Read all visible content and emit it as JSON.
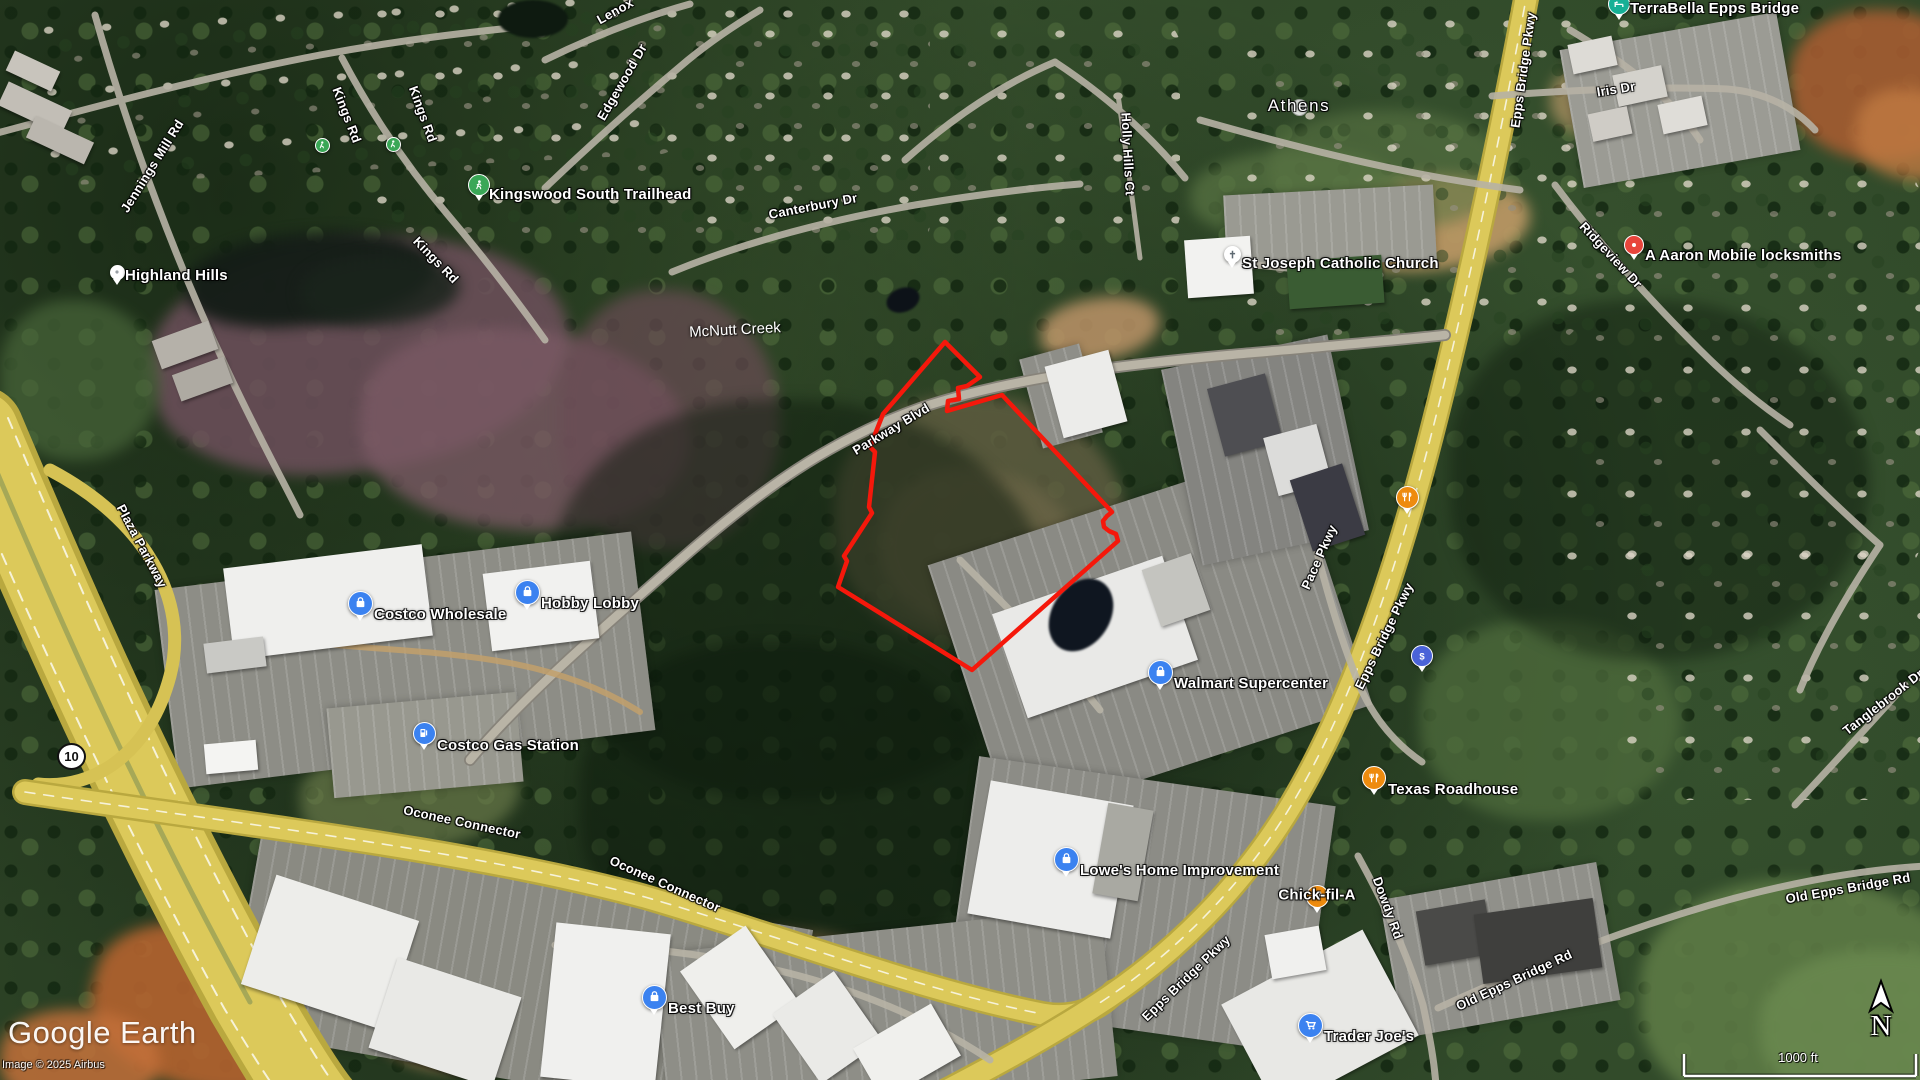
{
  "ui": {
    "logo": "Google Earth",
    "attribution": "Image © 2025 Airbus",
    "scale_label": "1000 ft",
    "north_label": "N",
    "route_shield": "10"
  },
  "map": {
    "pin_colors": {
      "shop": "#3b82f0",
      "cart": "#3b82f0",
      "gas": "#3b82f0",
      "food": "#ee8b0e",
      "dollar": "#4a63d8",
      "dot-red": "#e8453c",
      "lodging": "#16b096",
      "trail": "#3aa757",
      "trail-small": "#3aa757",
      "dot-white": "#ffffff",
      "church": "#ffffff",
      "city": "rgba(255,255,255,0.85)"
    },
    "places": [
      {
        "id": "highland-hills",
        "label": "Highland Hills",
        "pin": "dot-white",
        "x": 117,
        "y": 272,
        "size": 15,
        "dx": 8,
        "dy": -5
      },
      {
        "id": "trail-dot-west",
        "label": "",
        "pin": "trail-small",
        "x": 322,
        "y": 145,
        "size": 15
      },
      {
        "id": "trail-dot-east",
        "label": "",
        "pin": "trail-small",
        "x": 393,
        "y": 144,
        "size": 15
      },
      {
        "id": "kingswood-south-trailhead",
        "label": "Kingswood South Trailhead",
        "pin": "trail",
        "x": 479,
        "y": 185,
        "size": 22,
        "dx": 10,
        "dy": 1
      },
      {
        "id": "athens",
        "label": "Athens",
        "pin": "city",
        "x": 1299,
        "y": 107,
        "size": 17,
        "mode": "over",
        "cls": "city"
      },
      {
        "id": "st-joseph-catholic-church",
        "label": "St Joseph Catholic Church",
        "pin": "church",
        "x": 1232,
        "y": 254,
        "size": 17,
        "dx": 10,
        "dy": 1
      },
      {
        "id": "a-aaron-mobile-locksmiths",
        "label": "A Aaron Mobile locksmiths",
        "pin": "dot-red",
        "x": 1634,
        "y": 245,
        "size": 20,
        "dx": 11,
        "dy": 2
      },
      {
        "id": "terrabella-epps-bridge",
        "label": "TerraBella Epps Bridge",
        "pin": "lodging",
        "x": 1619,
        "y": 4,
        "size": 22,
        "dx": 11,
        "dy": -4
      },
      {
        "id": "costco-wholesale",
        "label": "Costco Wholesale",
        "pin": "shop",
        "x": 360,
        "y": 603,
        "size": 25,
        "dx": 14,
        "dy": 3
      },
      {
        "id": "hobby-lobby",
        "label": "Hobby Lobby",
        "pin": "shop",
        "x": 527,
        "y": 592,
        "size": 25,
        "dx": 14,
        "dy": 3
      },
      {
        "id": "costco-gas-station",
        "label": "Costco Gas Station",
        "pin": "gas",
        "x": 424,
        "y": 733,
        "size": 23,
        "dx": 13,
        "dy": 4
      },
      {
        "id": "walmart-supercenter",
        "label": "Walmart Supercenter",
        "pin": "shop",
        "x": 1160,
        "y": 672,
        "size": 25,
        "dx": 14,
        "dy": 3
      },
      {
        "id": "restaurant",
        "label": "",
        "pin": "food",
        "x": 1407,
        "y": 497,
        "size": 23
      },
      {
        "id": "bank",
        "label": "",
        "pin": "dollar",
        "x": 1422,
        "y": 656,
        "size": 22
      },
      {
        "id": "texas-roadhouse",
        "label": "Texas Roadhouse",
        "pin": "food",
        "x": 1374,
        "y": 778,
        "size": 24,
        "dx": 14,
        "dy": 3
      },
      {
        "id": "lowes-home-improvement",
        "label": "Lowe's Home Improvement",
        "pin": "shop",
        "x": 1066,
        "y": 859,
        "size": 25,
        "dx": 14,
        "dy": 3
      },
      {
        "id": "chick-fil-a",
        "label": "Chick-fil-A",
        "pin": "food",
        "x": 1317,
        "y": 896,
        "size": 23,
        "mode": "over"
      },
      {
        "id": "best-buy",
        "label": "Best Buy",
        "pin": "shop",
        "x": 654,
        "y": 997,
        "size": 25,
        "dx": 14,
        "dy": 3
      },
      {
        "id": "trader-joes",
        "label": "Trader Joe's",
        "pin": "cart",
        "x": 1310,
        "y": 1025,
        "size": 25,
        "dx": 14,
        "dy": 3
      }
    ],
    "road_labels": [
      {
        "id": "jennings-mill-rd",
        "label": "Jennings Mill Rd",
        "x": 152,
        "y": 166,
        "rot": -58
      },
      {
        "id": "kings-rd-1",
        "label": "Kings Rd",
        "x": 347,
        "y": 115,
        "rot": 69
      },
      {
        "id": "kings-rd-2",
        "label": "Kings Rd",
        "x": 423,
        "y": 114,
        "rot": 70
      },
      {
        "id": "kings-rd-3",
        "label": "Kings Rd",
        "x": 436,
        "y": 260,
        "rot": 46
      },
      {
        "id": "lenox",
        "label": "Lenox",
        "x": 615,
        "y": 11,
        "rot": -29
      },
      {
        "id": "edgewood-dr",
        "label": "Edgewood Dr",
        "x": 622,
        "y": 82,
        "rot": -60
      },
      {
        "id": "canterbury-dr",
        "label": "Canterbury Dr",
        "x": 813,
        "y": 206,
        "rot": -11
      },
      {
        "id": "holly-hills-ct",
        "label": "Holly Hills Ct",
        "x": 1128,
        "y": 154,
        "rot": 87
      },
      {
        "id": "epps-bridge-pkwy-top",
        "label": "Epps Bridge Pkwy",
        "x": 1523,
        "y": 70,
        "rot": -82
      },
      {
        "id": "iris-dr",
        "label": "Iris Dr",
        "x": 1616,
        "y": 89,
        "rot": -9
      },
      {
        "id": "ridgeview-dr",
        "label": "Ridgeview Dr",
        "x": 1611,
        "y": 255,
        "rot": 47
      },
      {
        "id": "parkway-blvd",
        "label": "Parkway Blvd",
        "x": 891,
        "y": 429,
        "rot": -31
      },
      {
        "id": "plaza-parkway",
        "label": "Plaza Parkway",
        "x": 142,
        "y": 546,
        "rot": 62
      },
      {
        "id": "pace-pkwy",
        "label": "Pace Pkwy",
        "x": 1319,
        "y": 557,
        "rot": -66
      },
      {
        "id": "epps-bridge-pkwy-mid",
        "label": "Epps Bridge Pkwy",
        "x": 1384,
        "y": 636,
        "rot": -64
      },
      {
        "id": "tanglebrook-dr",
        "label": "Tanglebrook Dr",
        "x": 1883,
        "y": 702,
        "rot": -38
      },
      {
        "id": "oconee-connector-1",
        "label": "Oconee Connector",
        "x": 462,
        "y": 822,
        "rot": 12
      },
      {
        "id": "oconee-connector-2",
        "label": "Oconee Connector",
        "x": 665,
        "y": 884,
        "rot": 24
      },
      {
        "id": "dowdy-rd",
        "label": "Dowdy Rd",
        "x": 1388,
        "y": 908,
        "rot": 70
      },
      {
        "id": "old-epps-bridge-rd-east",
        "label": "Old Epps Bridge Rd",
        "x": 1848,
        "y": 888,
        "rot": -10
      },
      {
        "id": "old-epps-bridge-rd-south",
        "label": "Old Epps Bridge Rd",
        "x": 1514,
        "y": 980,
        "rot": -25
      },
      {
        "id": "epps-bridge-pkwy-bottom",
        "label": "Epps Bridge Pkwy",
        "x": 1186,
        "y": 978,
        "rot": -44
      }
    ],
    "nature_labels": [
      {
        "id": "mcnutt-creek",
        "label": "McNutt Creek",
        "x": 735,
        "y": 330,
        "rot": -3
      }
    ],
    "parcel_outline": {
      "color": "#f5180b",
      "stroke_width": 4.5,
      "points": [
        [
          883,
          414
        ],
        [
          945,
          342
        ],
        [
          980,
          377
        ],
        [
          967,
          386
        ],
        [
          958,
          388
        ],
        [
          959,
          399
        ],
        [
          948,
          401
        ],
        [
          947,
          411
        ],
        [
          1002,
          395
        ],
        [
          1112,
          512
        ],
        [
          1107,
          516
        ],
        [
          1103,
          521
        ],
        [
          1104,
          527
        ],
        [
          1109,
          531
        ],
        [
          1116,
          534
        ],
        [
          1118,
          541
        ],
        [
          972,
          670
        ],
        [
          838,
          587
        ],
        [
          847,
          561
        ],
        [
          844,
          556
        ],
        [
          872,
          513
        ],
        [
          869,
          507
        ],
        [
          875,
          452
        ],
        [
          870,
          447
        ]
      ]
    }
  }
}
